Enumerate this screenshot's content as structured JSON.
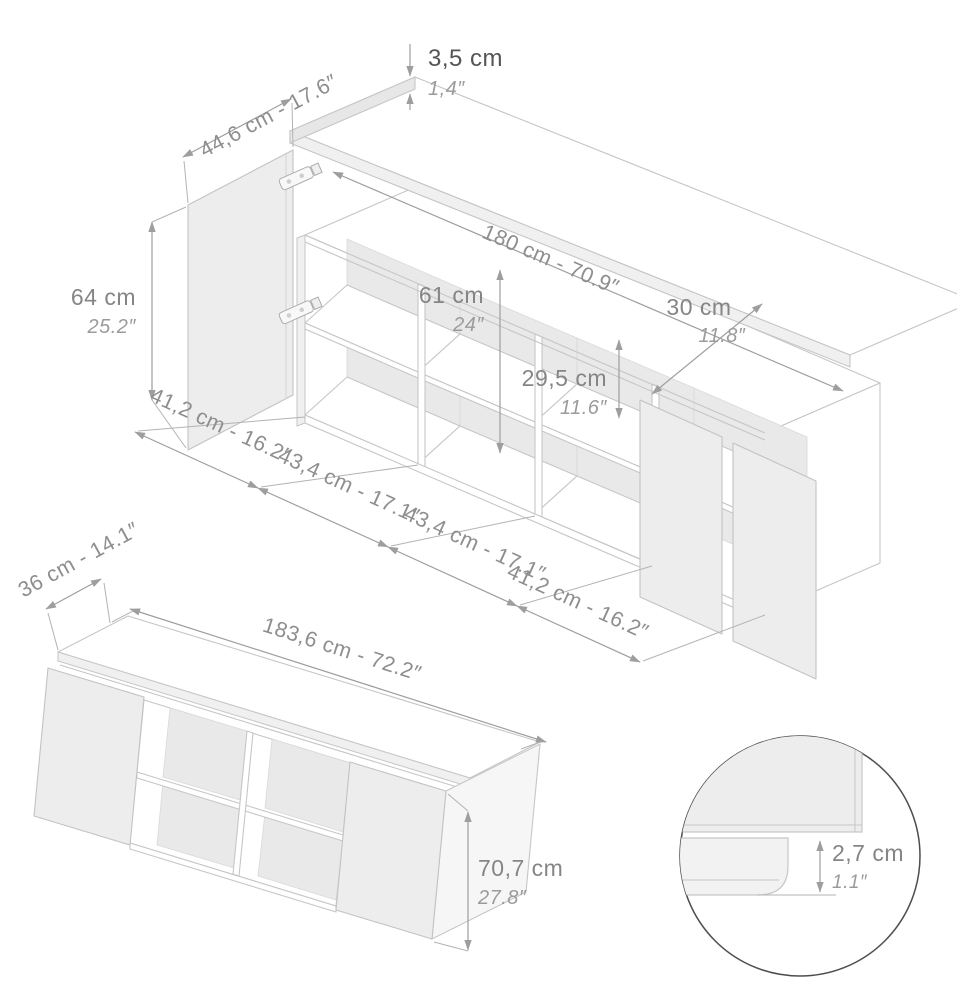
{
  "top_view": {
    "thickness": {
      "cm": "3,5 cm",
      "in": "1,4″"
    },
    "door_width": "44,6 cm - 17.6″",
    "length": "180 cm - 70.9″",
    "height": {
      "cm": "64 cm",
      "in": "25.2″"
    },
    "interior_height": {
      "cm": "61 cm",
      "in": "24″"
    },
    "top_depth": {
      "cm": "30 cm",
      "in": "11.8″"
    },
    "opening_height": {
      "cm": "29,5 cm",
      "in": "11.6″"
    },
    "compartments": [
      "41,2 cm - 16.2″",
      "43,4 cm - 17.1″",
      "43,4 cm - 17.1″",
      "41,2 cm - 16.2″"
    ]
  },
  "assembled_view": {
    "depth": "36 cm - 14.1″",
    "width": "183,6 cm - 72.2″",
    "height": {
      "cm": "70,7 cm",
      "in": "27.8″"
    }
  },
  "detail_view": {
    "plinth": {
      "cm": "2,7 cm",
      "in": "1.1″"
    }
  },
  "colors": {
    "furniture_line": "#c6c6c6",
    "dimension_line": "#9e9e9e",
    "label_gray": "#858585",
    "label_dark": "#555555",
    "label_inch": "#9b9b9b",
    "panel_fill": "#ededed",
    "back_fill": "#e9e9e9",
    "detail_circle": "#4d4d4d"
  }
}
